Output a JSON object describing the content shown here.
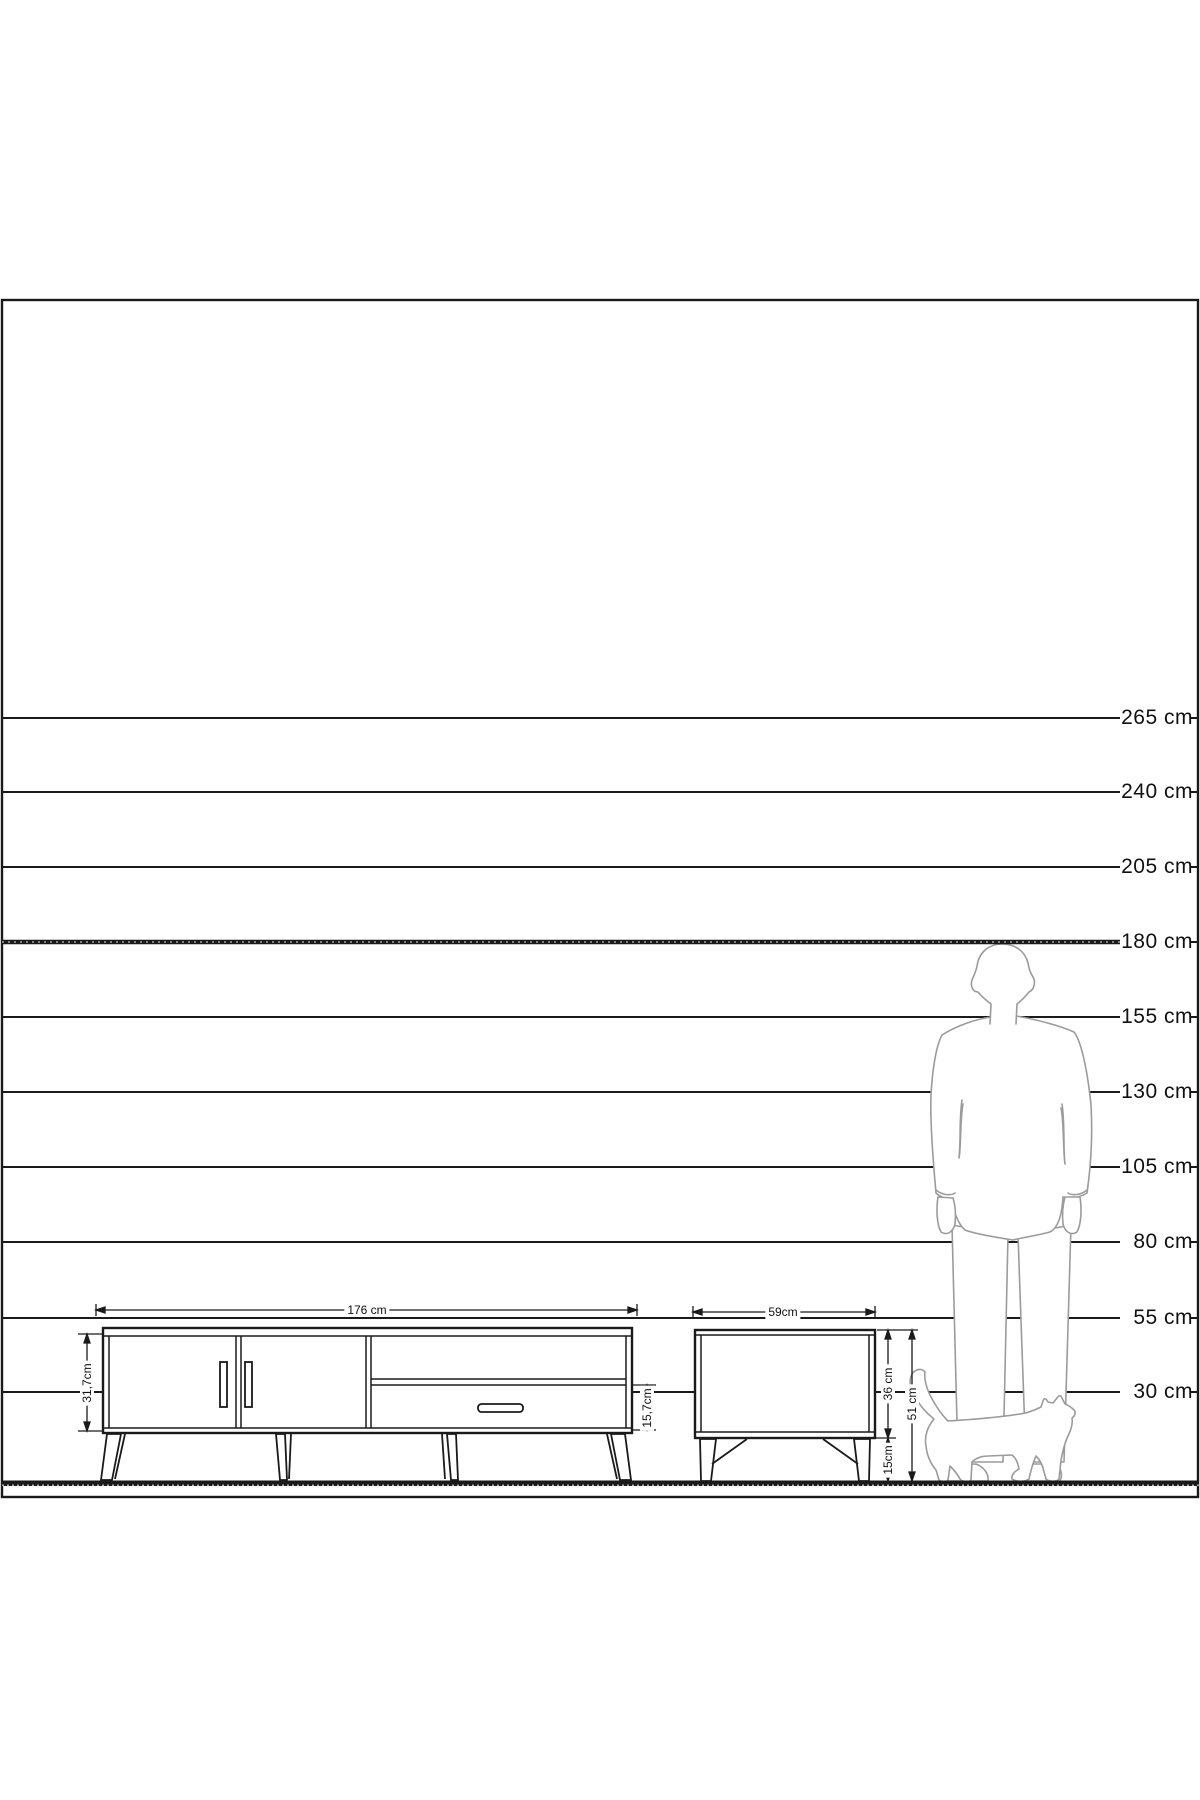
{
  "scale": {
    "unit": "cm",
    "lines": [
      {
        "label": "265 cm",
        "value_cm": 265
      },
      {
        "label": "240 cm",
        "value_cm": 240
      },
      {
        "label": "205 cm",
        "value_cm": 205
      },
      {
        "label": "180 cm",
        "value_cm": 180,
        "bold": true
      },
      {
        "label": "155 cm",
        "value_cm": 155
      },
      {
        "label": "130 cm",
        "value_cm": 130
      },
      {
        "label": "105 cm",
        "value_cm": 105
      },
      {
        "label": "80 cm",
        "value_cm": 80
      },
      {
        "label": "55 cm",
        "value_cm": 55
      },
      {
        "label": "30 cm",
        "value_cm": 30
      }
    ]
  },
  "tv_stand": {
    "width_label": "176 cm",
    "body_height_label": "31,7cm",
    "drawer_height_label": "15,7cm"
  },
  "side_table": {
    "width_label": "59cm",
    "body_height_label": "36 cm",
    "leg_height_label": "15cm",
    "total_height_label": "51 cm"
  },
  "colors": {
    "line": "#1a1a1a",
    "silhouette": "#9b9b9b",
    "background": "#ffffff"
  }
}
